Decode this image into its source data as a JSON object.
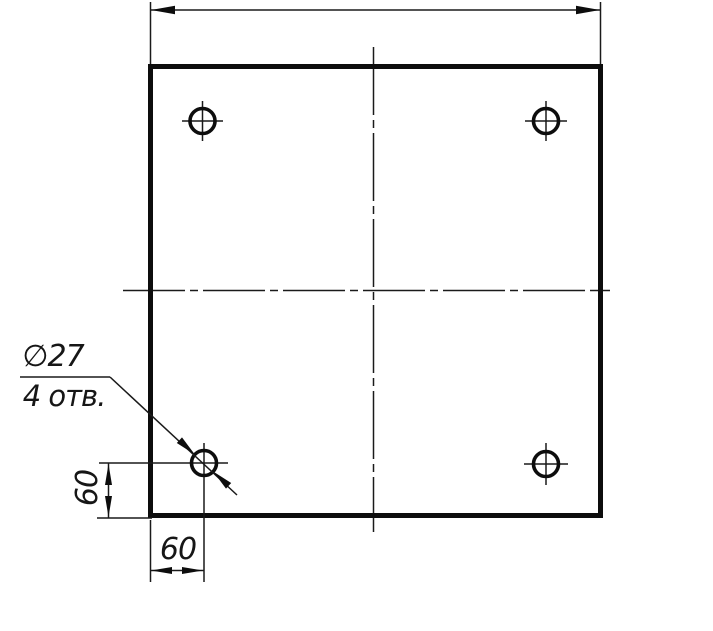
{
  "drawing": {
    "kind": "engineering plate drawing, front view",
    "line_color": "#0d0d0d",
    "background": "#ffffff",
    "labels": {
      "hole_diameter": "∅27",
      "hole_count": "4 отв.",
      "offset_vertical": "60",
      "offset_horizontal": "60"
    },
    "depicted": {
      "hole_count": 4,
      "hole_diameter": 27,
      "hole_offset_from_bottom_edge": 60,
      "hole_offset_from_left_edge": 60,
      "top_dimension_value_shown": ""
    }
  }
}
